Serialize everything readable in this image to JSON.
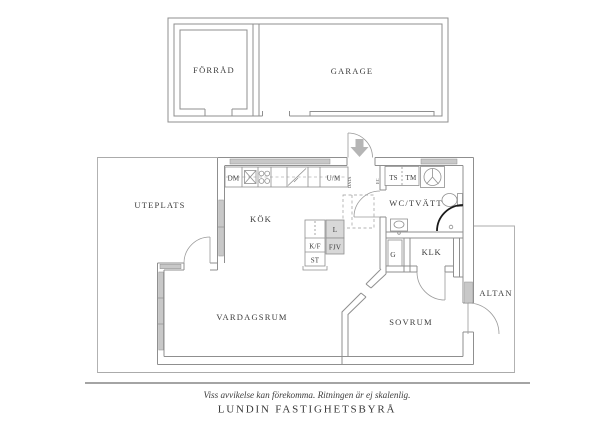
{
  "colors": {
    "wall": "#8f8f8f",
    "thin_outline": "#ababab",
    "window_fill": "#c8c8c8",
    "unit_fill": "#d8d8d8",
    "arrow": "#b5b5b5",
    "dark_arc": "#1a1a1a",
    "text": "#3b3b3b"
  },
  "outbuilding": {
    "forrad": "FÖRRÅD",
    "garage": "GARAGE"
  },
  "rooms": {
    "uteplats": "UTEPLATS",
    "kok": "KÖK",
    "wc_tvatt": "WC/TVÄTT",
    "vardagsrum": "VARDAGSRUM",
    "sovrum": "SOVRUM",
    "klk": "KLK",
    "altan": "ALTAN",
    "garderob": "G"
  },
  "fixtures": {
    "dm": "DM",
    "um": "U/M",
    "ts": "TS",
    "tm": "TM",
    "kf": "K/F",
    "st": "ST",
    "l": "L",
    "fjv": "FJV",
    "data": "DATA",
    "ec": "EC"
  },
  "footer": {
    "disclaimer": "Viss avvikelse kan förekomma. Ritningen är ej skalenlig.",
    "brand": "LUNDIN FASTIGHETSBYRÅ"
  }
}
